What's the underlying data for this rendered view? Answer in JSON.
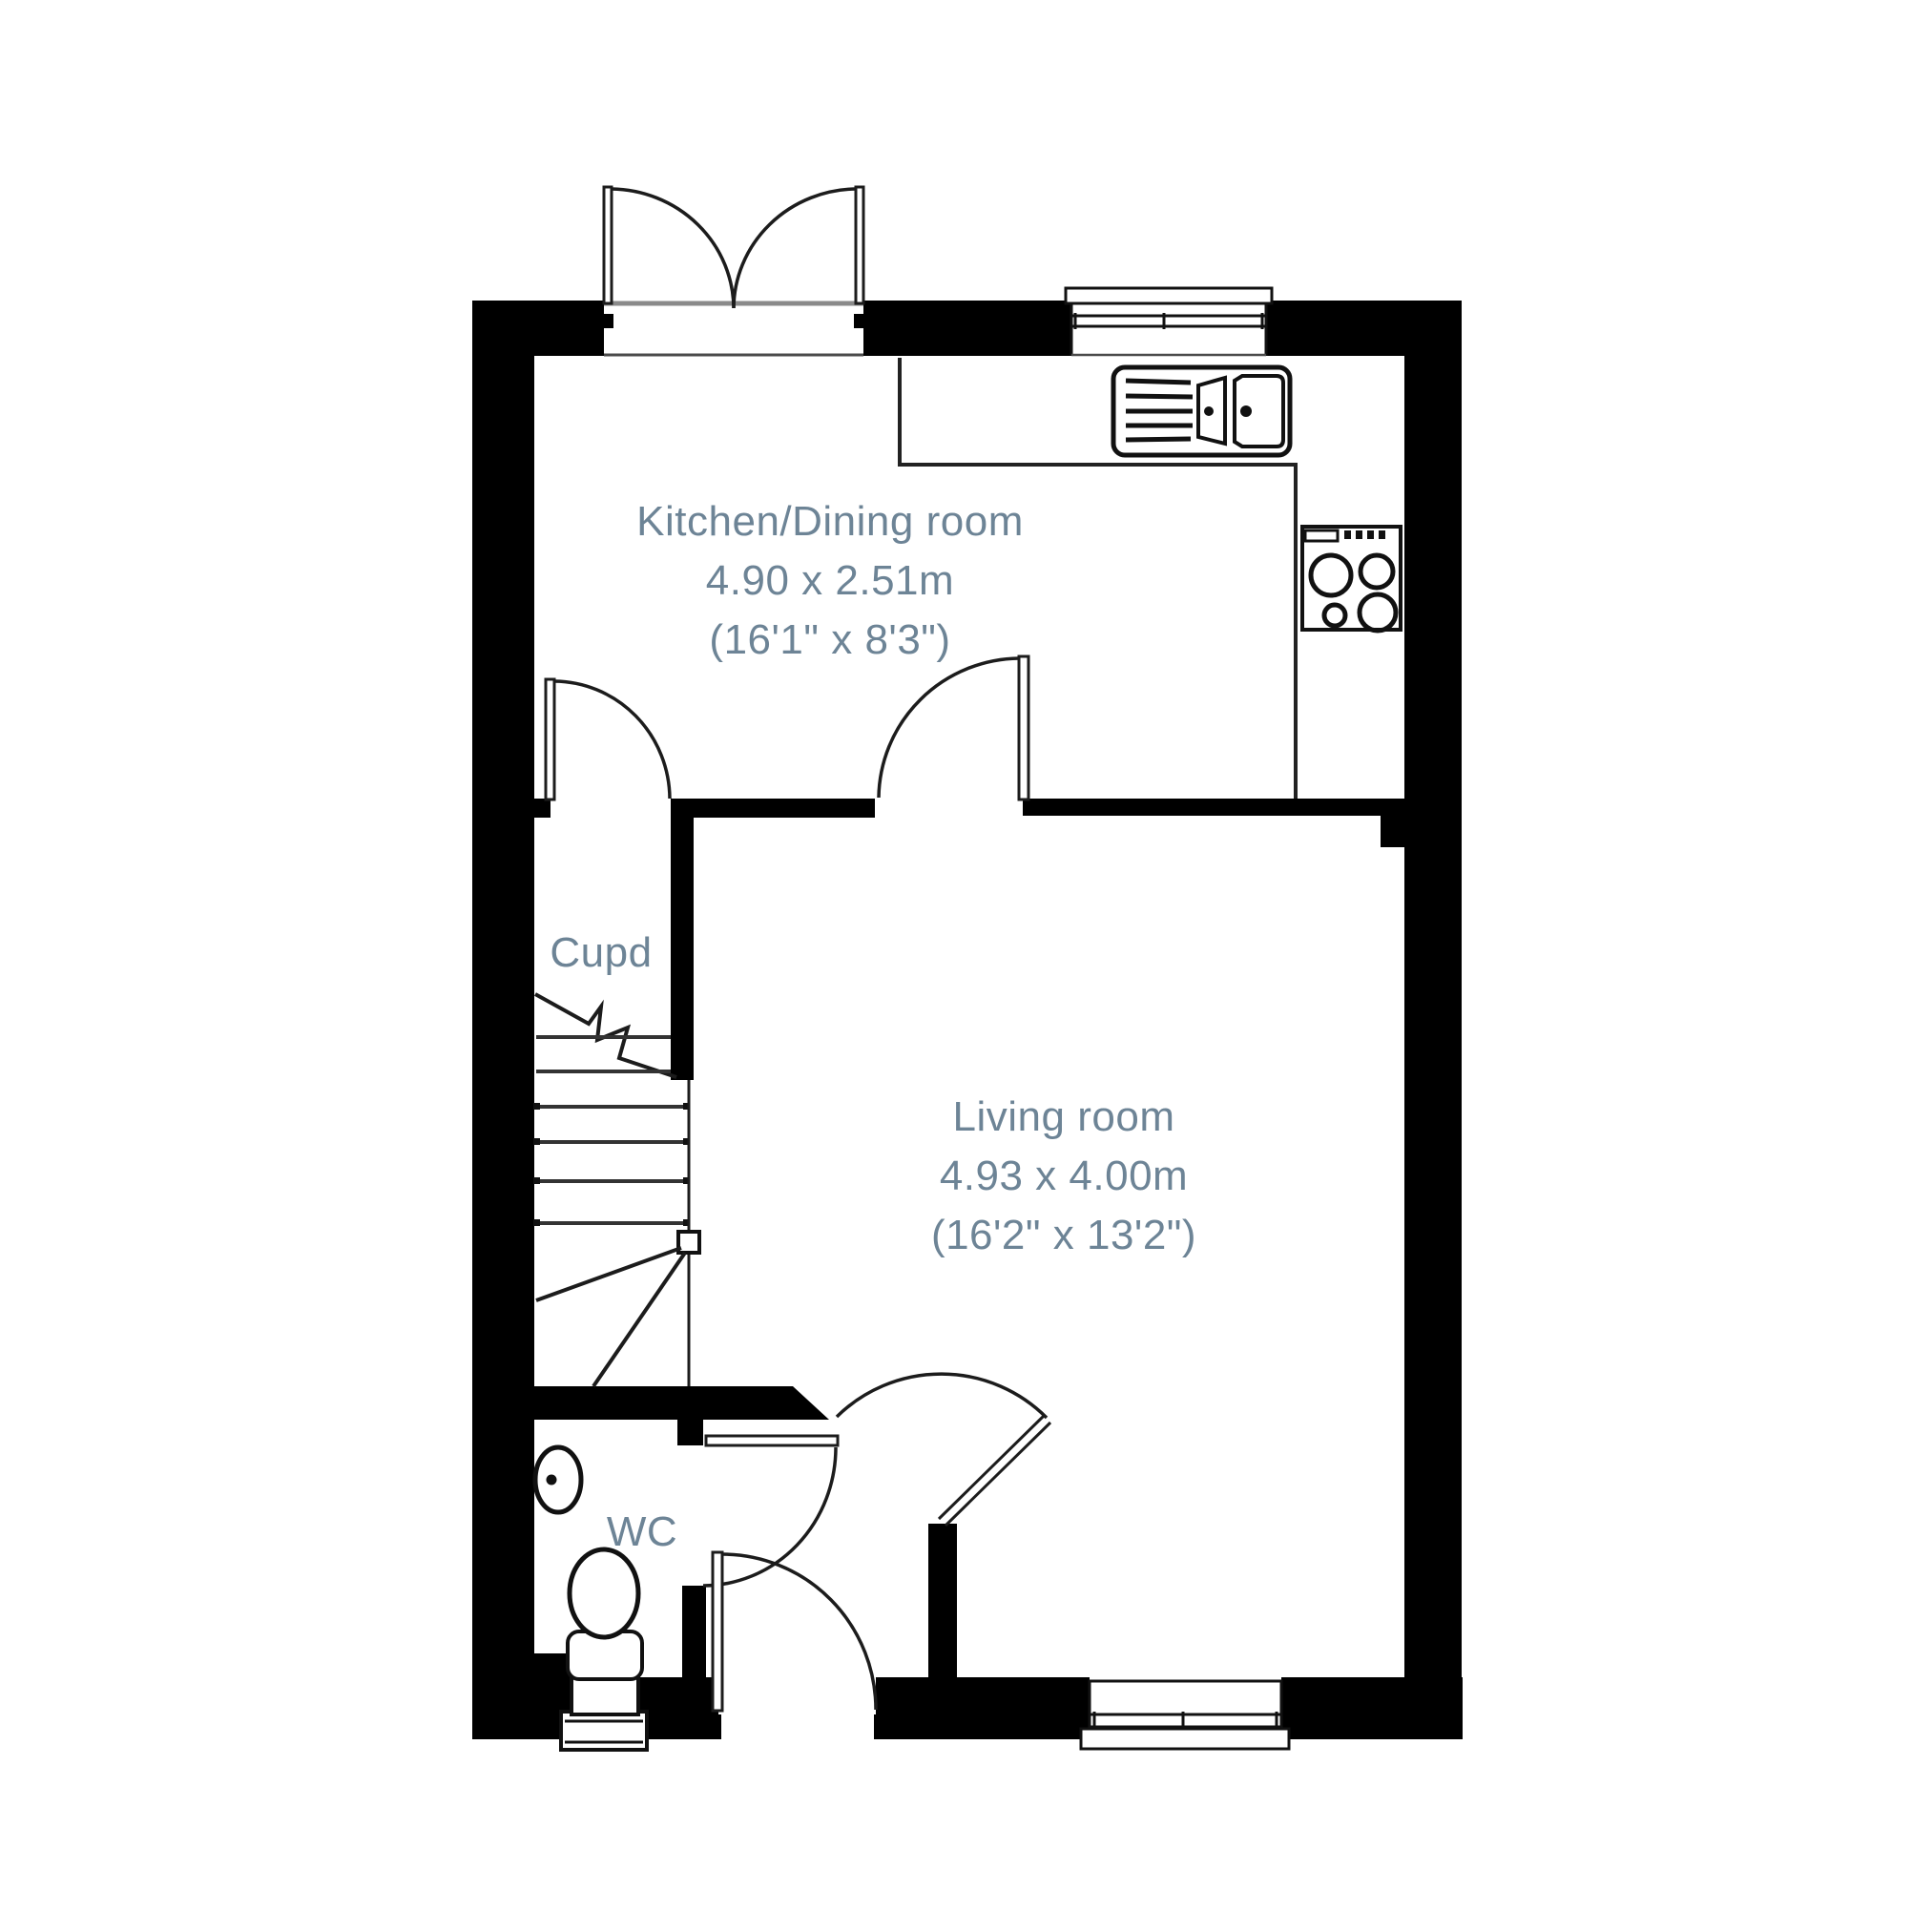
{
  "plan": {
    "title": "Ground floor plan",
    "rooms": [
      {
        "id": "kitchen-dining",
        "name": "Kitchen/Dining room",
        "dimensions_m": "4.90 x 2.51m",
        "dimensions_ft": "(16'1\" x 8'3\")"
      },
      {
        "id": "living-room",
        "name": "Living room",
        "dimensions_m": "4.93 x 4.00m",
        "dimensions_ft": "(16'2\" x 13'2\")"
      },
      {
        "id": "cupboard",
        "label": "Cupd"
      },
      {
        "id": "wc",
        "label": "WC"
      }
    ],
    "fixtures": [
      "french-doors",
      "kitchen-window",
      "kitchen-sink",
      "hob",
      "staircase",
      "wc-basin",
      "wc-toilet",
      "front-door",
      "living-room-window"
    ],
    "colors": {
      "wall": "#000000",
      "line": "#1c1c1c",
      "label": "#6d8496",
      "background": "#ffffff"
    }
  }
}
